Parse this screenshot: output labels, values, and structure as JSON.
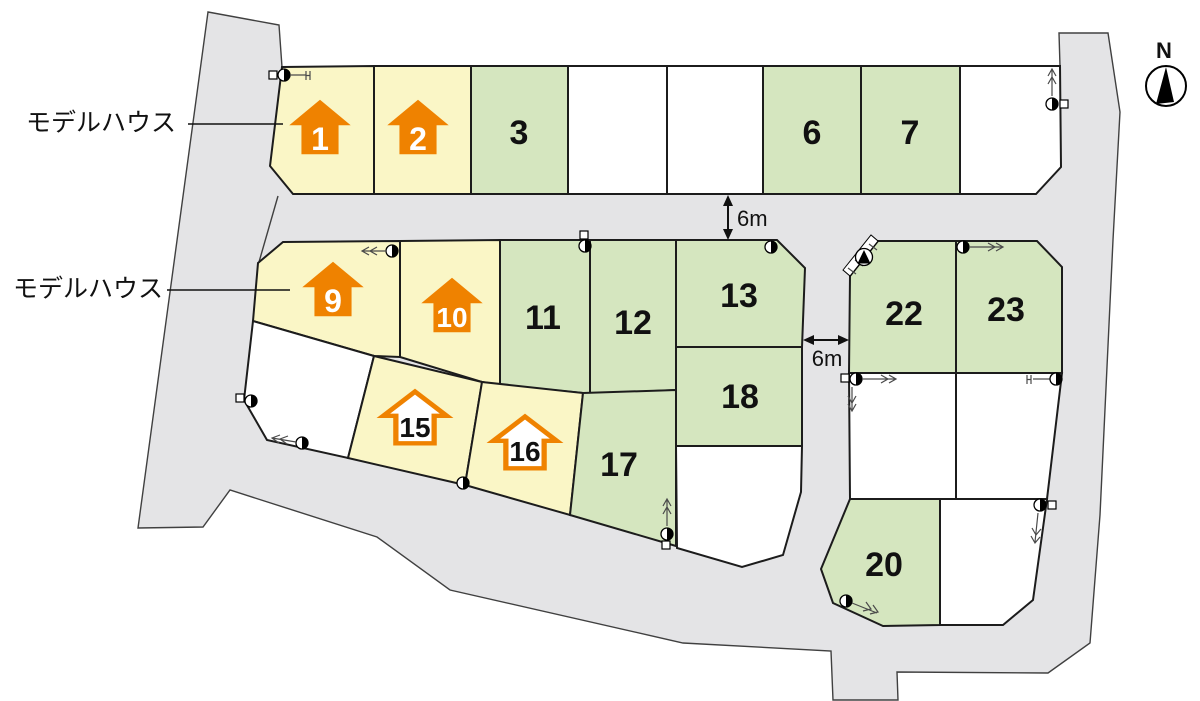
{
  "palette": {
    "road_gray": "#e4e4e6",
    "lot_green": "#d5e6bf",
    "lot_yellow": "#faf6c6",
    "lot_white": "#ffffff",
    "house_icon_orange": "#ef8200",
    "outline_black": "#1c1c1c"
  },
  "labels": {
    "model_house_top": "モデルハウス",
    "model_house_middle": "モデルハウス",
    "road_width_vertical": "6m",
    "road_width_horizontal": "6m",
    "compass_north": "N"
  },
  "icons": {
    "utility-pole-icon": "half-filled circle",
    "boundary-marker-icon": "small square",
    "hydrant-marker-icon": "circle with triangle",
    "house-arrow-icon": "upward house-shaped arrow",
    "north-needle-icon": "compass needle"
  },
  "lots": [
    {
      "id": 1,
      "label": "1",
      "fill": "yellow",
      "icon": "house-solid"
    },
    {
      "id": 2,
      "label": "2",
      "fill": "yellow",
      "icon": "house-solid"
    },
    {
      "id": 3,
      "label": "3",
      "fill": "green",
      "icon": null
    },
    {
      "id": 6,
      "label": "6",
      "fill": "green",
      "icon": null
    },
    {
      "id": 7,
      "label": "7",
      "fill": "green",
      "icon": null
    },
    {
      "id": 9,
      "label": "9",
      "fill": "yellow",
      "icon": "house-solid"
    },
    {
      "id": 10,
      "label": "10",
      "fill": "yellow",
      "icon": "house-solid"
    },
    {
      "id": 11,
      "label": "11",
      "fill": "green",
      "icon": null
    },
    {
      "id": 12,
      "label": "12",
      "fill": "green",
      "icon": null
    },
    {
      "id": 13,
      "label": "13",
      "fill": "green",
      "icon": null
    },
    {
      "id": 15,
      "label": "15",
      "fill": "yellow",
      "icon": "house-outline"
    },
    {
      "id": 16,
      "label": "16",
      "fill": "yellow",
      "icon": "house-outline"
    },
    {
      "id": 17,
      "label": "17",
      "fill": "green",
      "icon": null
    },
    {
      "id": 18,
      "label": "18",
      "fill": "green",
      "icon": null
    },
    {
      "id": 20,
      "label": "20",
      "fill": "green",
      "icon": null
    },
    {
      "id": 22,
      "label": "22",
      "fill": "green",
      "icon": null
    },
    {
      "id": 23,
      "label": "23",
      "fill": "green",
      "icon": null
    }
  ]
}
